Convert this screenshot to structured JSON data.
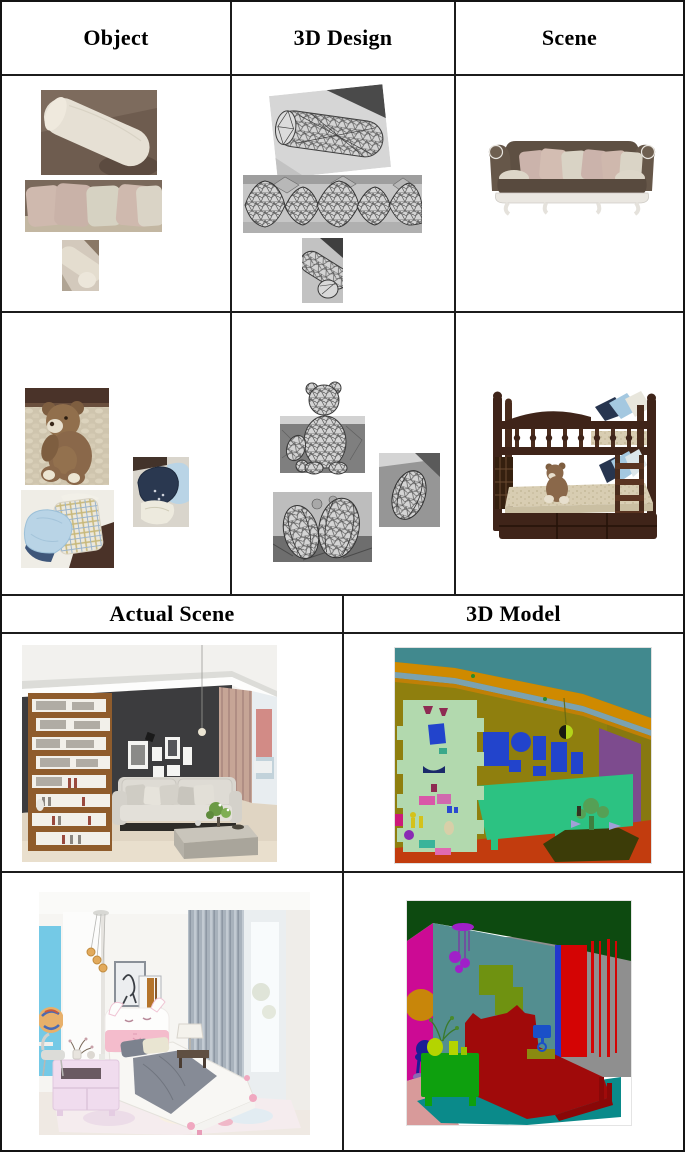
{
  "headers_top": {
    "object": "Object",
    "design": "3D Design",
    "scene": "Scene"
  },
  "headers_bottom": {
    "actual": "Actual Scene",
    "model": "3D Model"
  },
  "palette": {
    "seg_living": {
      "ceiling": "#41898e",
      "trim": "#cf8a00",
      "wall": "#8f7f0e",
      "shelf": "#b2d9ae",
      "frames": "#2244cc",
      "sofa": "#2cc282",
      "curtain": "#7d4b8e",
      "floor": "#c23c0e",
      "table": "#3c3c08",
      "plant": "#55a055"
    },
    "seg_bedroom": {
      "ceiling": "#0d4a10",
      "left_wall": "#cc0a94",
      "partition": "#538e90",
      "right_wall": "#8f8f8f",
      "curtain": "#d40404",
      "bed": "#a00a0a",
      "nightstand": "#0ea00e",
      "lamp": "#1a50c8",
      "rug": "#0a8a8a",
      "floor": "#d89a9a",
      "frames": "#6f9211",
      "pendant": "#a020c8",
      "vases": "#b4d400",
      "wall_circle": "#c8860a",
      "chair": "#1c1c96"
    },
    "photo_living": {
      "wall": "#3c3c3e",
      "sofa": "#d9d6cf",
      "curtain": "#c6a596",
      "floor": "#e0d5c3",
      "shelf_wood": "#8f5c2c"
    },
    "photo_bedroom": {
      "accent_wall": "#74c9e6",
      "headboard_pink": "#f4bccc",
      "blanket": "#868b96",
      "nightstand": "#f0dcee"
    },
    "sofa_render": {
      "body": "#5e5043",
      "pillow_pink": "#cbb3ab",
      "pillow_cream": "#d9d3c5",
      "base": "#eae7e1"
    },
    "bunk_bed": {
      "wood": "#3f2419",
      "pillow_navy": "#27354f",
      "pillow_blue": "#a4c8e0",
      "teddy": "#8a684a"
    },
    "object_photos": {
      "bolster": "#e6e0d4",
      "bolster_bg": "#6e5c4f",
      "pillow_pink": "#cfb9ae",
      "teddy": "#8a684a",
      "pillow_blue": "#b9d4e6",
      "pillow_navy": "#2a3850"
    }
  }
}
